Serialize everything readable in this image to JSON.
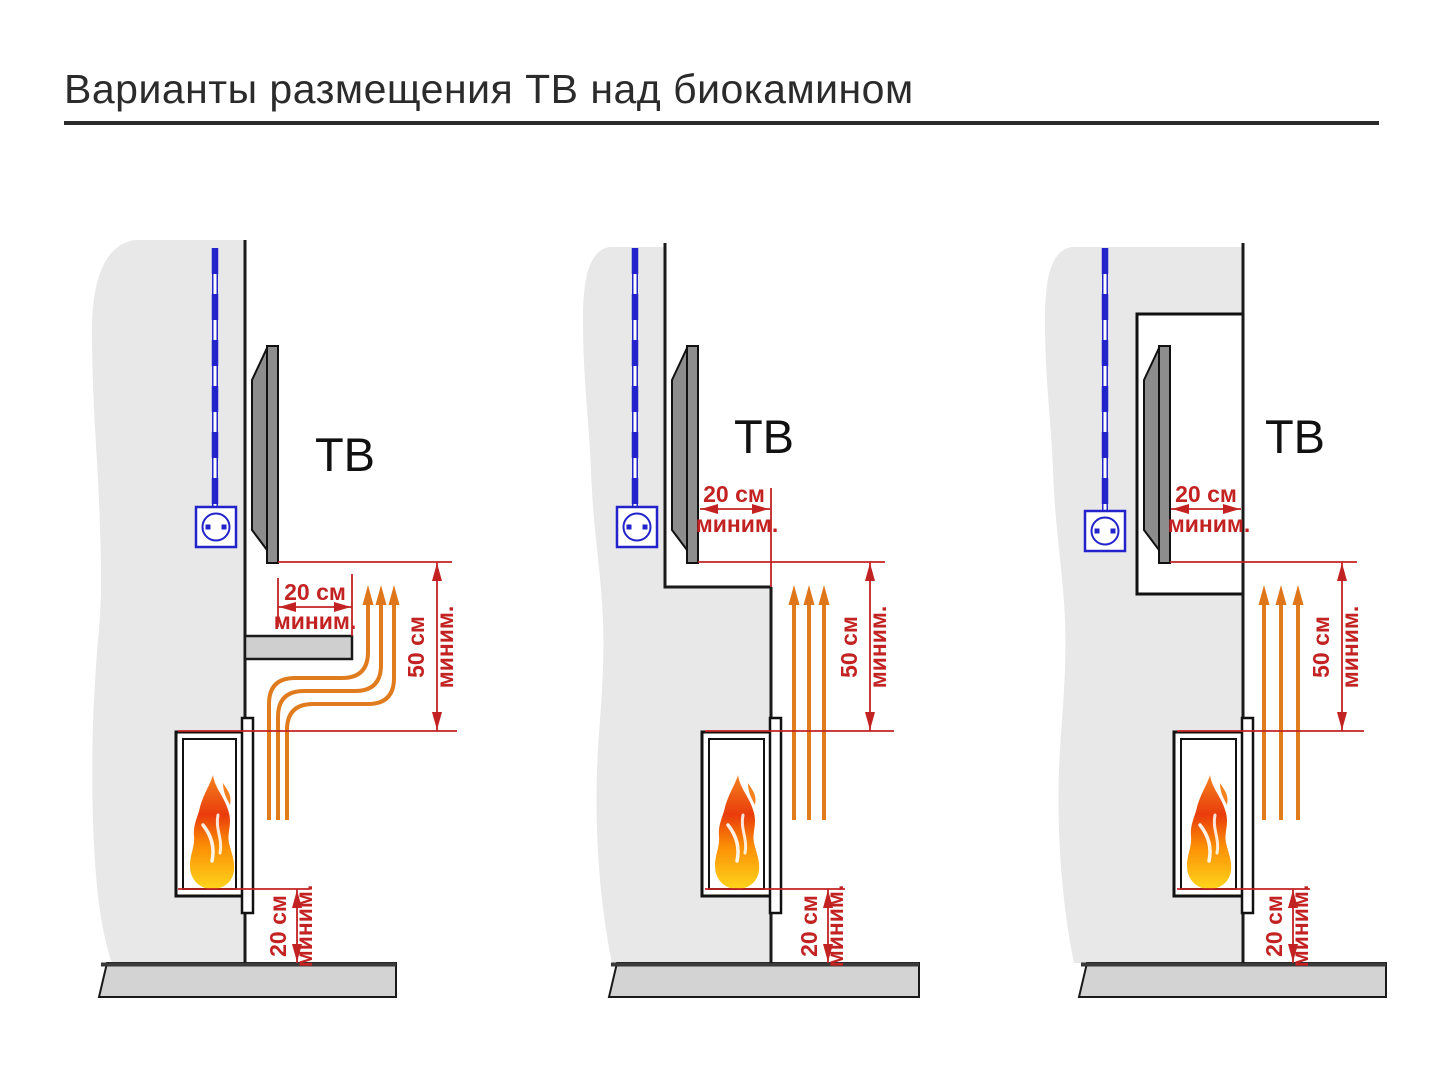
{
  "title": "Варианты размещения ТВ над биокамином",
  "colors": {
    "dimension_red": "#c32222",
    "cable_blue": "#2323cc",
    "heat_orange": "#e07c1e",
    "wall_gray": "#e8e8e8",
    "floor_gray": "#d3d3d3",
    "tv_gray": "#8d8d8d",
    "flame_top": "#f5821f",
    "flame_mid": "#e93c0c",
    "flame_bottom": "#ffd51c"
  },
  "diagrams": [
    {
      "tv_label": "ТВ",
      "dim_gap": {
        "value": "20 см",
        "qualifier": "миним."
      },
      "dim_height": {
        "value": "50 см",
        "qualifier": "миним."
      },
      "dim_floor": {
        "value": "20 см",
        "qualifier": "миним."
      }
    },
    {
      "tv_label": "ТВ",
      "dim_gap": {
        "value": "20 см",
        "qualifier": "миним."
      },
      "dim_height": {
        "value": "50 см",
        "qualifier": "миним."
      },
      "dim_floor": {
        "value": "20 см",
        "qualifier": "миним."
      }
    },
    {
      "tv_label": "ТВ",
      "dim_gap": {
        "value": "20 см",
        "qualifier": "миним."
      },
      "dim_height": {
        "value": "50 см",
        "qualifier": "миним."
      },
      "dim_floor": {
        "value": "20 см",
        "qualifier": "миним."
      }
    }
  ]
}
